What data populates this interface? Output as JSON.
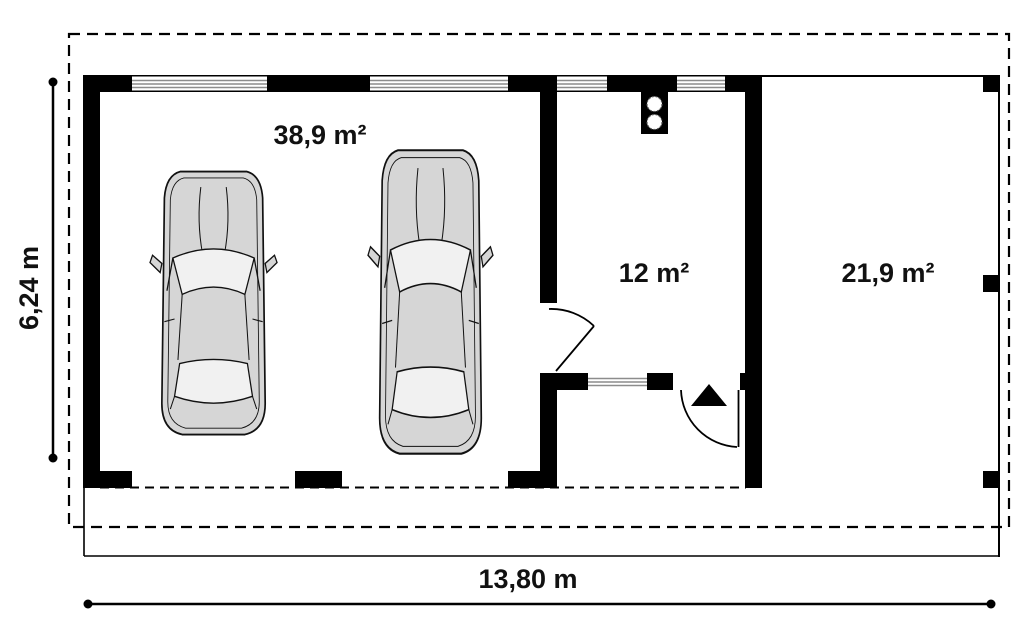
{
  "plan": {
    "rooms": {
      "garage": {
        "area_label": "38,9 m²"
      },
      "utility": {
        "area_label": "12 m²"
      },
      "terrace": {
        "area_label": "21,9 m²"
      }
    },
    "dimensions": {
      "height_label": "6,24 m",
      "width_label": "13,80 m"
    },
    "symbols": {
      "cars": "car-top-view",
      "chimney": "chimney-two-flues",
      "entrance": "entrance-arrow-triangle",
      "doors": "door-swing-arc",
      "windows": "striped-window-in-wall",
      "roof": "dashed-roof-overhang-outline"
    },
    "colors": {
      "wall": "#000000",
      "line": "#000000",
      "car_body": "#d6d6d6",
      "car_glass": "#f1f1f1",
      "window_stripe": "#8c8c8c",
      "background": "#ffffff"
    }
  }
}
